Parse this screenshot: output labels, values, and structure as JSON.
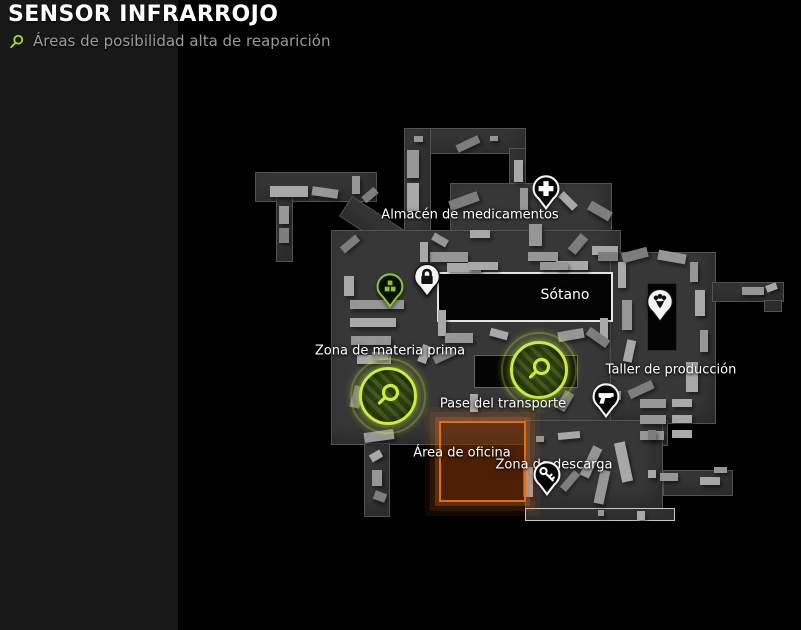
{
  "header": {
    "title": "SENSOR INFRARROJO",
    "subtitle": "Áreas de posibilidad alta de reaparición"
  },
  "colors": {
    "accent_green": "#c9ee3e",
    "marker_green": "#8ac32e",
    "zone_orange": "#e06c1c"
  },
  "map": {
    "labels": [
      {
        "id": "almacen",
        "text": "Almacén de medicamentos",
        "x": 470,
        "y": 215,
        "big": false
      },
      {
        "id": "sotano",
        "text": "Sótano",
        "x": 565,
        "y": 295,
        "big": true
      },
      {
        "id": "materia",
        "text": "Zona de materia prima",
        "x": 390,
        "y": 351,
        "big": false
      },
      {
        "id": "taller",
        "text": "Taller de producción",
        "x": 671,
        "y": 370,
        "big": false
      },
      {
        "id": "pase",
        "text": "Pase del transporte",
        "x": 503,
        "y": 404,
        "big": false
      },
      {
        "id": "oficina",
        "text": "Área de oficina",
        "x": 462,
        "y": 453,
        "big": false
      },
      {
        "id": "descarga",
        "text": "Zona de descarga",
        "x": 554,
        "y": 465,
        "big": false
      }
    ],
    "pins": [
      {
        "type": "medical",
        "icon": "medical-cross-icon",
        "x": 546,
        "y": 189
      },
      {
        "type": "lock",
        "icon": "lock-icon",
        "x": 427,
        "y": 277
      },
      {
        "type": "crate",
        "icon": "supply-crates-icon",
        "x": 390,
        "y": 287
      },
      {
        "type": "production",
        "icon": "production-marker-icon",
        "x": 660,
        "y": 302
      },
      {
        "type": "gun-ghost",
        "icon": "pistol-icon",
        "x": 530,
        "y": 358
      },
      {
        "type": "gun",
        "icon": "pistol-icon",
        "x": 606,
        "y": 397
      },
      {
        "type": "key",
        "icon": "key-icon",
        "x": 547,
        "y": 475
      }
    ],
    "hotspots": [
      {
        "id": "hotspot-materia-prima",
        "x": 388,
        "y": 396
      },
      {
        "id": "hotspot-pase-transporte",
        "x": 539,
        "y": 370
      }
    ]
  }
}
